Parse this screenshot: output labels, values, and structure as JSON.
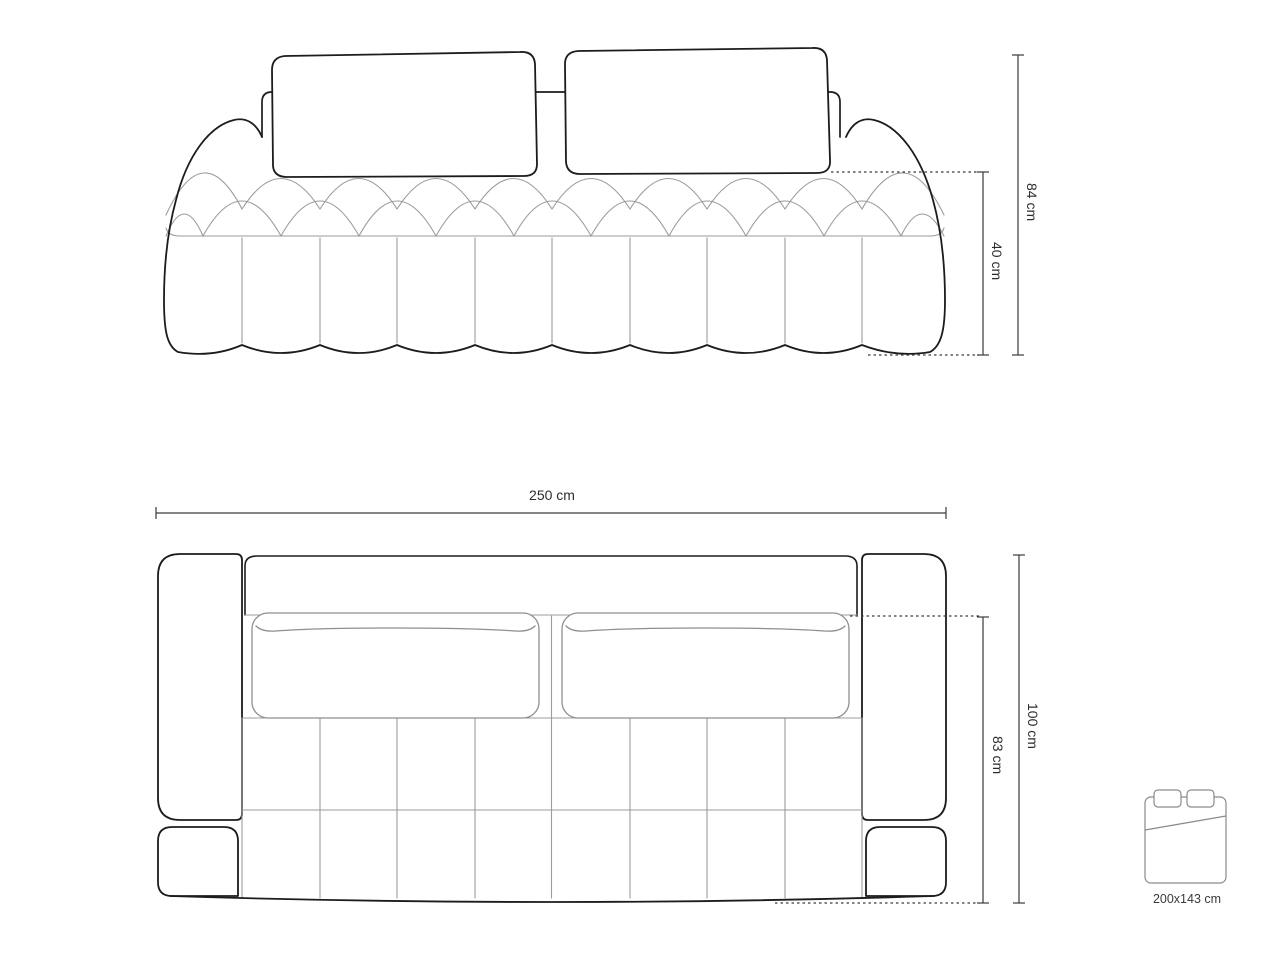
{
  "drawing_title": "sofa technical dimension drawing",
  "front_view": {
    "height_total_label": "84 cm",
    "height_seat_label": "40 cm"
  },
  "top_view": {
    "width_total_label": "250 cm",
    "depth_seat_label": "83 cm",
    "depth_total_label": "100 cm"
  },
  "sleeping_area": {
    "size_label": "200x143 cm"
  },
  "colors": {
    "outline": "#1c1c1c",
    "detail_line": "#9b9b9b",
    "cushion_line": "#8f8f8f",
    "dimension_line": "#3a3a3a",
    "label_text": "#2d2d2d",
    "bed_icon_line": "#8a8a8a",
    "background": "#ffffff"
  }
}
